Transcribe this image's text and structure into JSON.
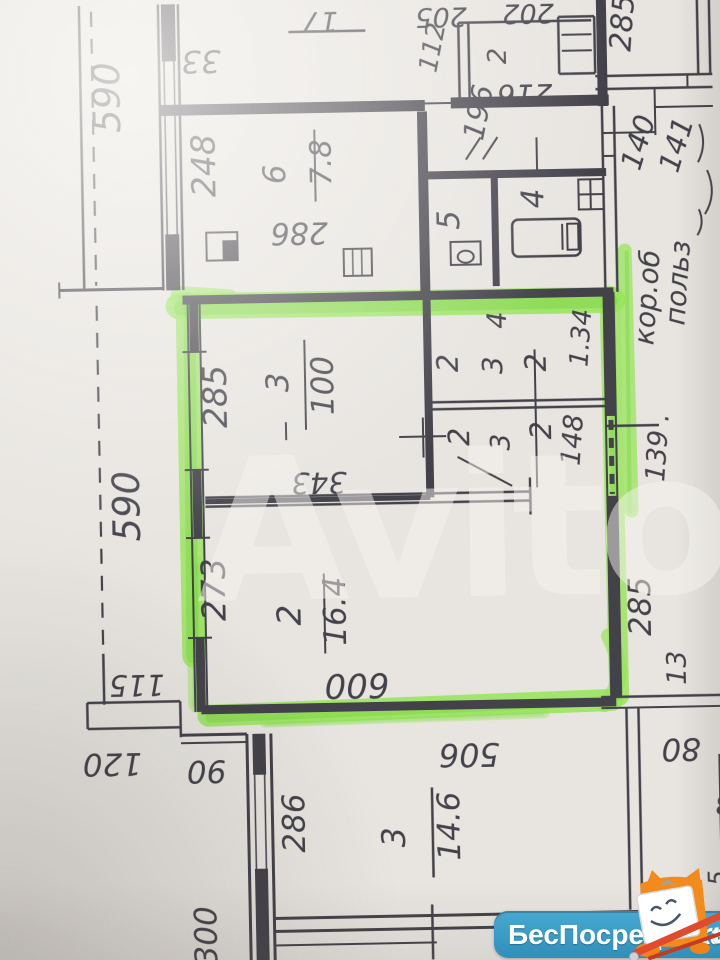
{
  "watermark": {
    "text": "Avito"
  },
  "branding": {
    "name": "БесПосредника",
    "tld": ".ru",
    "badge_color": "#3A9FC7"
  },
  "plan": {
    "ink": "#33323b",
    "highlight_light": "#8fe44c",
    "highlight_dark": "#6fd232",
    "labels": [
      {
        "t": "590",
        "x": 127,
        "y": 92,
        "r": -90,
        "s": 37
      },
      {
        "t": "248",
        "x": 221,
        "y": 162,
        "r": -90,
        "s": 33
      },
      {
        "t": "6",
        "x": 291,
        "y": 172,
        "r": -90,
        "s": 31
      },
      {
        "t": "7.8",
        "x": 337,
        "y": 161,
        "r": -90,
        "s": 29
      },
      {
        "t": "112",
        "x": 449,
        "y": 50,
        "r": -78,
        "s": 26
      },
      {
        "t": "2",
        "x": 514,
        "y": 58,
        "r": -90,
        "s": 26
      },
      {
        "t": "196",
        "x": 495,
        "y": 116,
        "r": -78,
        "s": 29
      },
      {
        "t": "5",
        "x": 464,
        "y": 221,
        "r": -90,
        "s": 31
      },
      {
        "t": "4",
        "x": 549,
        "y": 201,
        "r": -90,
        "s": 31
      },
      {
        "t": "285",
        "x": 641,
        "y": 28,
        "r": -85,
        "s": 30
      },
      {
        "t": "140",
        "x": 654,
        "y": 150,
        "r": -72,
        "s": 29
      },
      {
        "t": "141",
        "x": 692,
        "y": 153,
        "r": -72,
        "s": 29
      },
      {
        "t": "кор.об",
        "x": 660,
        "y": 303,
        "r": -85,
        "s": 28
      },
      {
        "t": "польз",
        "x": 691,
        "y": 289,
        "r": -85,
        "s": 28
      },
      {
        "t": "139 .",
        "x": 667,
        "y": 453,
        "r": -85,
        "s": 27
      },
      {
        "t": "285",
        "x": 228,
        "y": 393,
        "r": -90,
        "s": 33
      },
      {
        "t": "3",
        "x": 290,
        "y": 380,
        "r": -90,
        "s": 31
      },
      {
        "t": "100",
        "x": 335,
        "y": 384,
        "r": -90,
        "s": 31
      },
      {
        "t": "590",
        "x": 139,
        "y": 501,
        "r": -90,
        "s": 37
      },
      {
        "t": "4",
        "x": 509,
        "y": 322,
        "r": -90,
        "s": 27
      },
      {
        "t": "2",
        "x": 460,
        "y": 364,
        "r": -90,
        "s": 29
      },
      {
        "t": "3",
        "x": 504,
        "y": 367,
        "r": -90,
        "s": 28
      },
      {
        "t": "2",
        "x": 548,
        "y": 365,
        "r": -90,
        "s": 29
      },
      {
        "t": "2",
        "x": 470,
        "y": 438,
        "r": -90,
        "s": 29
      },
      {
        "t": "3",
        "x": 510,
        "y": 444,
        "r": -90,
        "s": 27
      },
      {
        "t": "2",
        "x": 552,
        "y": 433,
        "r": -90,
        "s": 29
      },
      {
        "t": "1.34",
        "x": 592,
        "y": 342,
        "r": -85,
        "s": 26
      },
      {
        "t": "148",
        "x": 582,
        "y": 444,
        "r": -85,
        "s": 27
      },
      {
        "t": "273",
        "x": 223,
        "y": 586,
        "r": -90,
        "s": 33
      },
      {
        "t": "2",
        "x": 298,
        "y": 613,
        "r": -90,
        "s": 33
      },
      {
        "t": "16.4",
        "x": 343,
        "y": 610,
        "r": -90,
        "s": 31
      },
      {
        "t": "285",
        "x": 648,
        "y": 611,
        "r": -90,
        "s": 31
      },
      {
        "t": "13",
        "x": 682,
        "y": 673,
        "r": -90,
        "s": 27
      },
      {
        "t": "286",
        "x": 298,
        "y": 821,
        "r": -90,
        "s": 31
      },
      {
        "t": "3",
        "x": 398,
        "y": 837,
        "r": -90,
        "s": 32
      },
      {
        "t": "14.6",
        "x": 453,
        "y": 827,
        "r": -90,
        "s": 31
      },
      {
        "t": "300",
        "x": 208,
        "y": 932,
        "r": -90,
        "s": 31
      },
      {
        "t": "5",
        "x": 718,
        "y": 884,
        "r": -90,
        "s": 25
      },
      {
        "t": "33",
        "x": 209,
        "y": 47,
        "r": 180,
        "s": 31
      },
      {
        "t": "17",
        "x": 329,
        "y": 11,
        "r": 180,
        "s": 28
      },
      {
        "t": "286",
        "x": 304,
        "y": 221,
        "r": 180,
        "s": 30
      },
      {
        "t": "205",
        "x": 450,
        "y": 9,
        "r": 180,
        "s": 27
      },
      {
        "t": "202",
        "x": 537,
        "y": 7,
        "r": 180,
        "s": 27
      },
      {
        "t": "216",
        "x": 532,
        "y": 87,
        "r": 180,
        "s": 29
      },
      {
        "t": "343",
        "x": 319,
        "y": 471,
        "r": 180,
        "s": 29
      },
      {
        "t": "115",
        "x": 133,
        "y": 670,
        "r": 180,
        "s": 29
      },
      {
        "t": "600",
        "x": 353,
        "y": 673,
        "r": 180,
        "s": 34
      },
      {
        "t": "120",
        "x": 107,
        "y": 748,
        "r": 180,
        "s": 31
      },
      {
        "t": "90",
        "x": 201,
        "y": 757,
        "r": 180,
        "s": 31
      },
      {
        "t": "80",
        "x": 676,
        "y": 744,
        "r": 180,
        "s": 31
      },
      {
        "t": "506",
        "x": 464,
        "y": 745,
        "r": 180,
        "s": 32
      },
      {
        "t": "3",
        "x": 717,
        "y": 801,
        "r": 180,
        "s": 27
      }
    ],
    "walls": [
      [
        88,
        0,
        88,
        284,
        2.5
      ],
      [
        63,
        284,
        166,
        284,
        3
      ],
      [
        63,
        276,
        63,
        292,
        2
      ],
      [
        83,
        697,
        176,
        697,
        2.5
      ],
      [
        83,
        723,
        176,
        723,
        2.5
      ],
      [
        83,
        697,
        83,
        723,
        2.5
      ],
      [
        176,
        697,
        176,
        723,
        2.5
      ],
      [
        100,
        648,
        100,
        699,
        2.5
      ],
      [
        176,
        723,
        176,
        733,
        2.5
      ],
      [
        176,
        731,
        242,
        731,
        3
      ],
      [
        176,
        739,
        242,
        739,
        2
      ],
      [
        167,
        0,
        167,
        286,
        2.5
      ],
      [
        187,
        0,
        187,
        286,
        2.5
      ],
      [
        177,
        0,
        177,
        57,
        14
      ],
      [
        177,
        230,
        177,
        286,
        14
      ],
      [
        172,
        57,
        172,
        230,
        1.5
      ],
      [
        182,
        57,
        182,
        230,
        1.5
      ],
      [
        166,
        106,
        432,
        106,
        11
      ],
      [
        432,
        104,
        458,
        104,
        2
      ],
      [
        458,
        104,
        616,
        104,
        11
      ],
      [
        297,
        30,
        374,
        30,
        2.5
      ],
      [
        467,
        24,
        600,
        24,
        2.5
      ],
      [
        467,
        24,
        467,
        100,
        2.5
      ],
      [
        477,
        24,
        477,
        100,
        2.5
      ],
      [
        567,
        20,
        567,
        77,
        2.5
      ],
      [
        603,
        20,
        603,
        77,
        2.5
      ],
      [
        567,
        20,
        603,
        20,
        2.5
      ],
      [
        567,
        77,
        603,
        77,
        2.5
      ],
      [
        570,
        38,
        600,
        38,
        2
      ],
      [
        570,
        54,
        600,
        54,
        2
      ],
      [
        610,
        0,
        610,
        110,
        10
      ],
      [
        609,
        110,
        609,
        296,
        2.5
      ],
      [
        621,
        110,
        621,
        296,
        2.5
      ],
      [
        609,
        137,
        662,
        137,
        2
      ],
      [
        662,
        93,
        662,
        140,
        2
      ],
      [
        609,
        160,
        621,
        160,
        2
      ],
      [
        603,
        80,
        720,
        80,
        2.5
      ],
      [
        603,
        93,
        720,
        93,
        2.5
      ],
      [
        663,
        112,
        720,
        112,
        2
      ],
      [
        706,
        0,
        706,
        80,
        2.5
      ],
      [
        718,
        0,
        718,
        80,
        2.5
      ],
      [
        695,
        80,
        695,
        93,
        2
      ],
      [
        429,
        112,
        429,
        296,
        10
      ],
      [
        432,
        176,
        612,
        176,
        8
      ],
      [
        500,
        180,
        500,
        288,
        7
      ],
      [
        543,
        140,
        543,
        172,
        2
      ],
      [
        472,
        161,
        487,
        139,
        2
      ],
      [
        489,
        161,
        504,
        139,
        2
      ],
      [
        186,
        296,
        617,
        296,
        9
      ],
      [
        191,
        296,
        191,
        708,
        2
      ],
      [
        203,
        296,
        203,
        708,
        2
      ],
      [
        197,
        296,
        197,
        348,
        9
      ],
      [
        197,
        466,
        197,
        534,
        9
      ],
      [
        197,
        634,
        197,
        708,
        9
      ],
      [
        185,
        348,
        209,
        348,
        2
      ],
      [
        185,
        466,
        209,
        466,
        2
      ],
      [
        185,
        534,
        209,
        534,
        2
      ],
      [
        185,
        634,
        209,
        634,
        2
      ],
      [
        197,
        706,
        612,
        706,
        9
      ],
      [
        607,
        296,
        607,
        702,
        2
      ],
      [
        617,
        296,
        617,
        702,
        2
      ],
      [
        612,
        296,
        612,
        420,
        9
      ],
      [
        612,
        500,
        612,
        702,
        9
      ],
      [
        607,
        430,
        660,
        430,
        2.5
      ],
      [
        205,
        494,
        530,
        494,
        2.5
      ],
      [
        205,
        503,
        530,
        503,
        2.5
      ],
      [
        205,
        498,
        430,
        498,
        5
      ],
      [
        530,
        480,
        530,
        517,
        2.5
      ],
      [
        430,
        296,
        430,
        498,
        8
      ],
      [
        430,
        403,
        612,
        403,
        2.5
      ],
      [
        430,
        410,
        612,
        410,
        2.5
      ],
      [
        537,
        352,
        537,
        490,
        2
      ],
      [
        400,
        437,
        447,
        437,
        2
      ],
      [
        424,
        418,
        424,
        458,
        2
      ],
      [
        458,
        458,
        512,
        488,
        2
      ],
      [
        287,
        420,
        287,
        438,
        2
      ],
      [
        321,
        128,
        321,
        200,
        2
      ],
      [
        307,
        338,
        307,
        428,
        2
      ],
      [
        322,
        572,
        322,
        652,
        2
      ],
      [
        426,
        788,
        426,
        878,
        2.5
      ],
      [
        242,
        731,
        242,
        960,
        3
      ],
      [
        266,
        731,
        266,
        960,
        3
      ],
      [
        254,
        731,
        254,
        772,
        13
      ],
      [
        254,
        866,
        254,
        960,
        13
      ],
      [
        249,
        772,
        249,
        866,
        1.5
      ],
      [
        259,
        772,
        259,
        866,
        1.5
      ],
      [
        597,
        701,
        720,
        701,
        2.5
      ],
      [
        597,
        712,
        720,
        712,
        2
      ],
      [
        622,
        712,
        622,
        914,
        2.5
      ],
      [
        634,
        712,
        634,
        914,
        2.5
      ],
      [
        266,
        916,
        634,
        916,
        3
      ],
      [
        266,
        929,
        634,
        929,
        3
      ],
      [
        266,
        943,
        428,
        943,
        2
      ],
      [
        424,
        905,
        424,
        960,
        2.5
      ],
      [
        714,
        760,
        714,
        912,
        2
      ]
    ],
    "dashed": [
      [
        100,
        6,
        100,
        280,
        2.2,
        "15,12"
      ],
      [
        100,
        300,
        100,
        646,
        2.2,
        "15,12"
      ],
      [
        612,
        424,
        612,
        498,
        5,
        "10,8"
      ]
    ],
    "green": [
      [
        182,
        302,
        616,
        304,
        26,
        0.85
      ],
      [
        205,
        296,
        420,
        298,
        12,
        0.45
      ],
      [
        184,
        292,
        232,
        296,
        20,
        0.7
      ],
      [
        191,
        300,
        191,
        652,
        24,
        0.8
      ],
      [
        193,
        560,
        193,
        700,
        18,
        0.5
      ],
      [
        204,
        712,
        608,
        704,
        22,
        0.85
      ],
      [
        260,
        720,
        540,
        716,
        10,
        0.4
      ],
      [
        613,
        300,
        615,
        700,
        20,
        0.8
      ],
      [
        629,
        255,
        631,
        515,
        14,
        0.75
      ]
    ],
    "green_curves": [
      {
        "d": "M606,640 Q627,684 600,708",
        "w": 16,
        "o": 0.7
      }
    ],
    "rects": [
      [
        455,
        243,
        30,
        23,
        2,
        0
      ],
      [
        517,
        222,
        68,
        37,
        2.5,
        6
      ],
      [
        572,
        227,
        11,
        26,
        2,
        0
      ],
      [
        584,
        183,
        25,
        30,
        2,
        0
      ],
      [
        348,
        248,
        28,
        27,
        2,
        0
      ],
      [
        211,
        229,
        31,
        28,
        2,
        0
      ]
    ],
    "fills": [
      [
        227,
        237,
        14,
        19
      ]
    ],
    "extra_lines": [
      [
        567,
        227,
        567,
        253,
        2
      ],
      [
        584,
        198,
        609,
        198,
        2
      ],
      [
        596,
        183,
        596,
        213,
        2
      ],
      [
        357,
        248,
        357,
        275,
        1.5
      ],
      [
        366,
        248,
        366,
        275,
        1.5
      ]
    ],
    "ellipses": [
      [
        470,
        258,
        8,
        6,
        2
      ]
    ],
    "scribbles": [
      "M706,130 q8,20 -2,38",
      "M713,176 q10,24 -3,44",
      "M704,215 q6,14 -2,26"
    ]
  }
}
